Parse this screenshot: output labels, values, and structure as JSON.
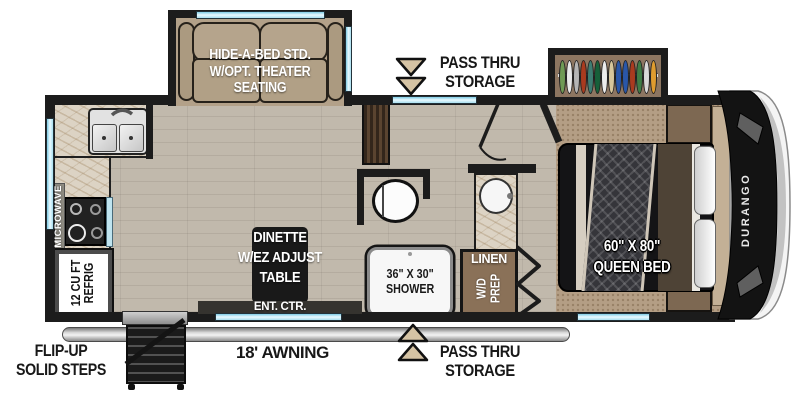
{
  "scene": {
    "type": "rv-fifth-wheel-floorplan"
  },
  "colors": {
    "wall": "#1c1c1c",
    "wood_floor": "#c1b9ac",
    "carpet": "#b49e85",
    "counter_marble": "#dcd3c4",
    "cushion_tan": "#b5a48c",
    "cabinet_brown": "#8a7158",
    "pantry_brown": "#4a3729",
    "window_glass": "#aadeef",
    "awning_gray": "#c7c7c7",
    "front_cap_black": "#131313",
    "front_cap_white": "#f4f4f4",
    "label_black": "#181818",
    "label_white": "#ffffff"
  },
  "labels": {
    "pass_thru_top": {
      "line1": "PASS THRU",
      "line2": "STORAGE"
    },
    "pass_thru_bottom": {
      "line1": "PASS THRU",
      "line2": "STORAGE"
    },
    "hide_a_bed": {
      "line1": "HIDE-A-BED STD.",
      "line2": "W/OPT. THEATER",
      "line3": "SEATING"
    },
    "microwave": "MICROWAVE",
    "refrig": {
      "line1": "12 CU FT",
      "line2": "REFRIG"
    },
    "dinette": {
      "line1": "DINETTE",
      "line2": "W/EZ ADJUST",
      "line3": "TABLE"
    },
    "ent_ctr": "ENT. CTR.",
    "shower": {
      "line1": "36\" X 30\"",
      "line2": "SHOWER"
    },
    "linen": "LINEN",
    "wd_prep": {
      "line1": "W/D",
      "line2": "PREP"
    },
    "queen_bed": {
      "line1": "60\" X 80\"",
      "line2": "QUEEN BED"
    },
    "flip_up_steps": {
      "line1": "FLIP-UP",
      "line2": "SOLID STEPS"
    },
    "awning": "18' AWNING",
    "brand": "DURANGO"
  },
  "wardrobe": {
    "clothes_colors": [
      "#6f9a55",
      "#e9e9e9",
      "#b5b5b5",
      "#a93b1f",
      "#3e7d72",
      "#17603a",
      "#ececec",
      "#d7c69b",
      "#2a57a8",
      "#2a57a8",
      "#a93b1f",
      "#3f7d46",
      "#d9d9d9",
      "#df9c2f"
    ]
  }
}
